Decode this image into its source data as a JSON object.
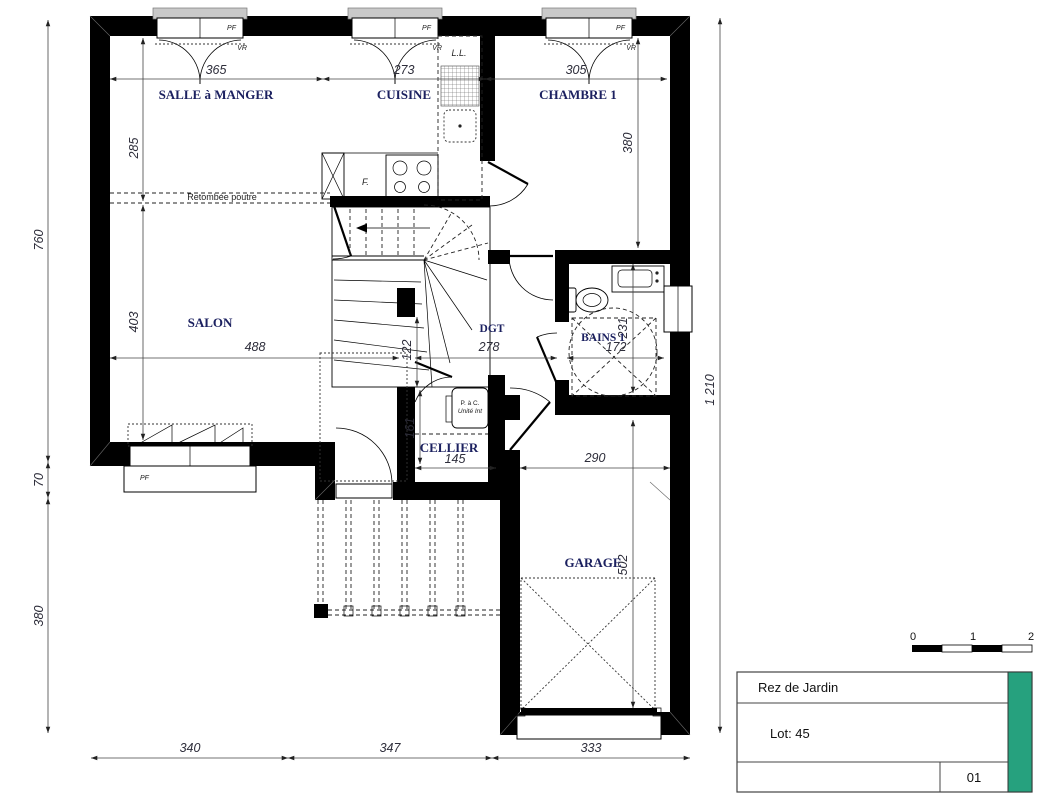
{
  "colors": {
    "accent_green": "#26A17E",
    "wall_black": "#000000",
    "room_text": "#1c2160"
  },
  "rooms": {
    "dining": "SALLE à MANGER",
    "kitchen": "CUISINE",
    "bedroom": "CHAMBRE 1",
    "living": "SALON",
    "hall": "DGT",
    "bath": "BAINS 1",
    "cellar": "CELLIER",
    "garage": "GARAGE"
  },
  "labels": {
    "beam": "Retombée poutre",
    "washer": "L.L.",
    "appliance_f": "F.",
    "pac_line1": "P. à C.",
    "pac_line2": "Unité Int",
    "window_pf": "PF",
    "shutter_vr": "VR"
  },
  "dims": {
    "top": [
      "365",
      "273",
      "305"
    ],
    "dining_height": "285",
    "living_height": "403",
    "bedroom_height": "380",
    "left": [
      "760",
      "70",
      "380"
    ],
    "right_total": "1 210",
    "middle": [
      "488",
      "278",
      "172"
    ],
    "passage": "122",
    "bath_height": "231",
    "cellar_width": "145",
    "cellar_height": "161",
    "garage_width": "290",
    "garage_height": "502",
    "bottom": [
      "340",
      "347",
      "333"
    ]
  },
  "scalebar": {
    "ticks": [
      "0",
      "1",
      "2"
    ]
  },
  "titleblock": {
    "title": "Rez de Jardin",
    "lot": "Lot: 45",
    "sheet": "01"
  }
}
